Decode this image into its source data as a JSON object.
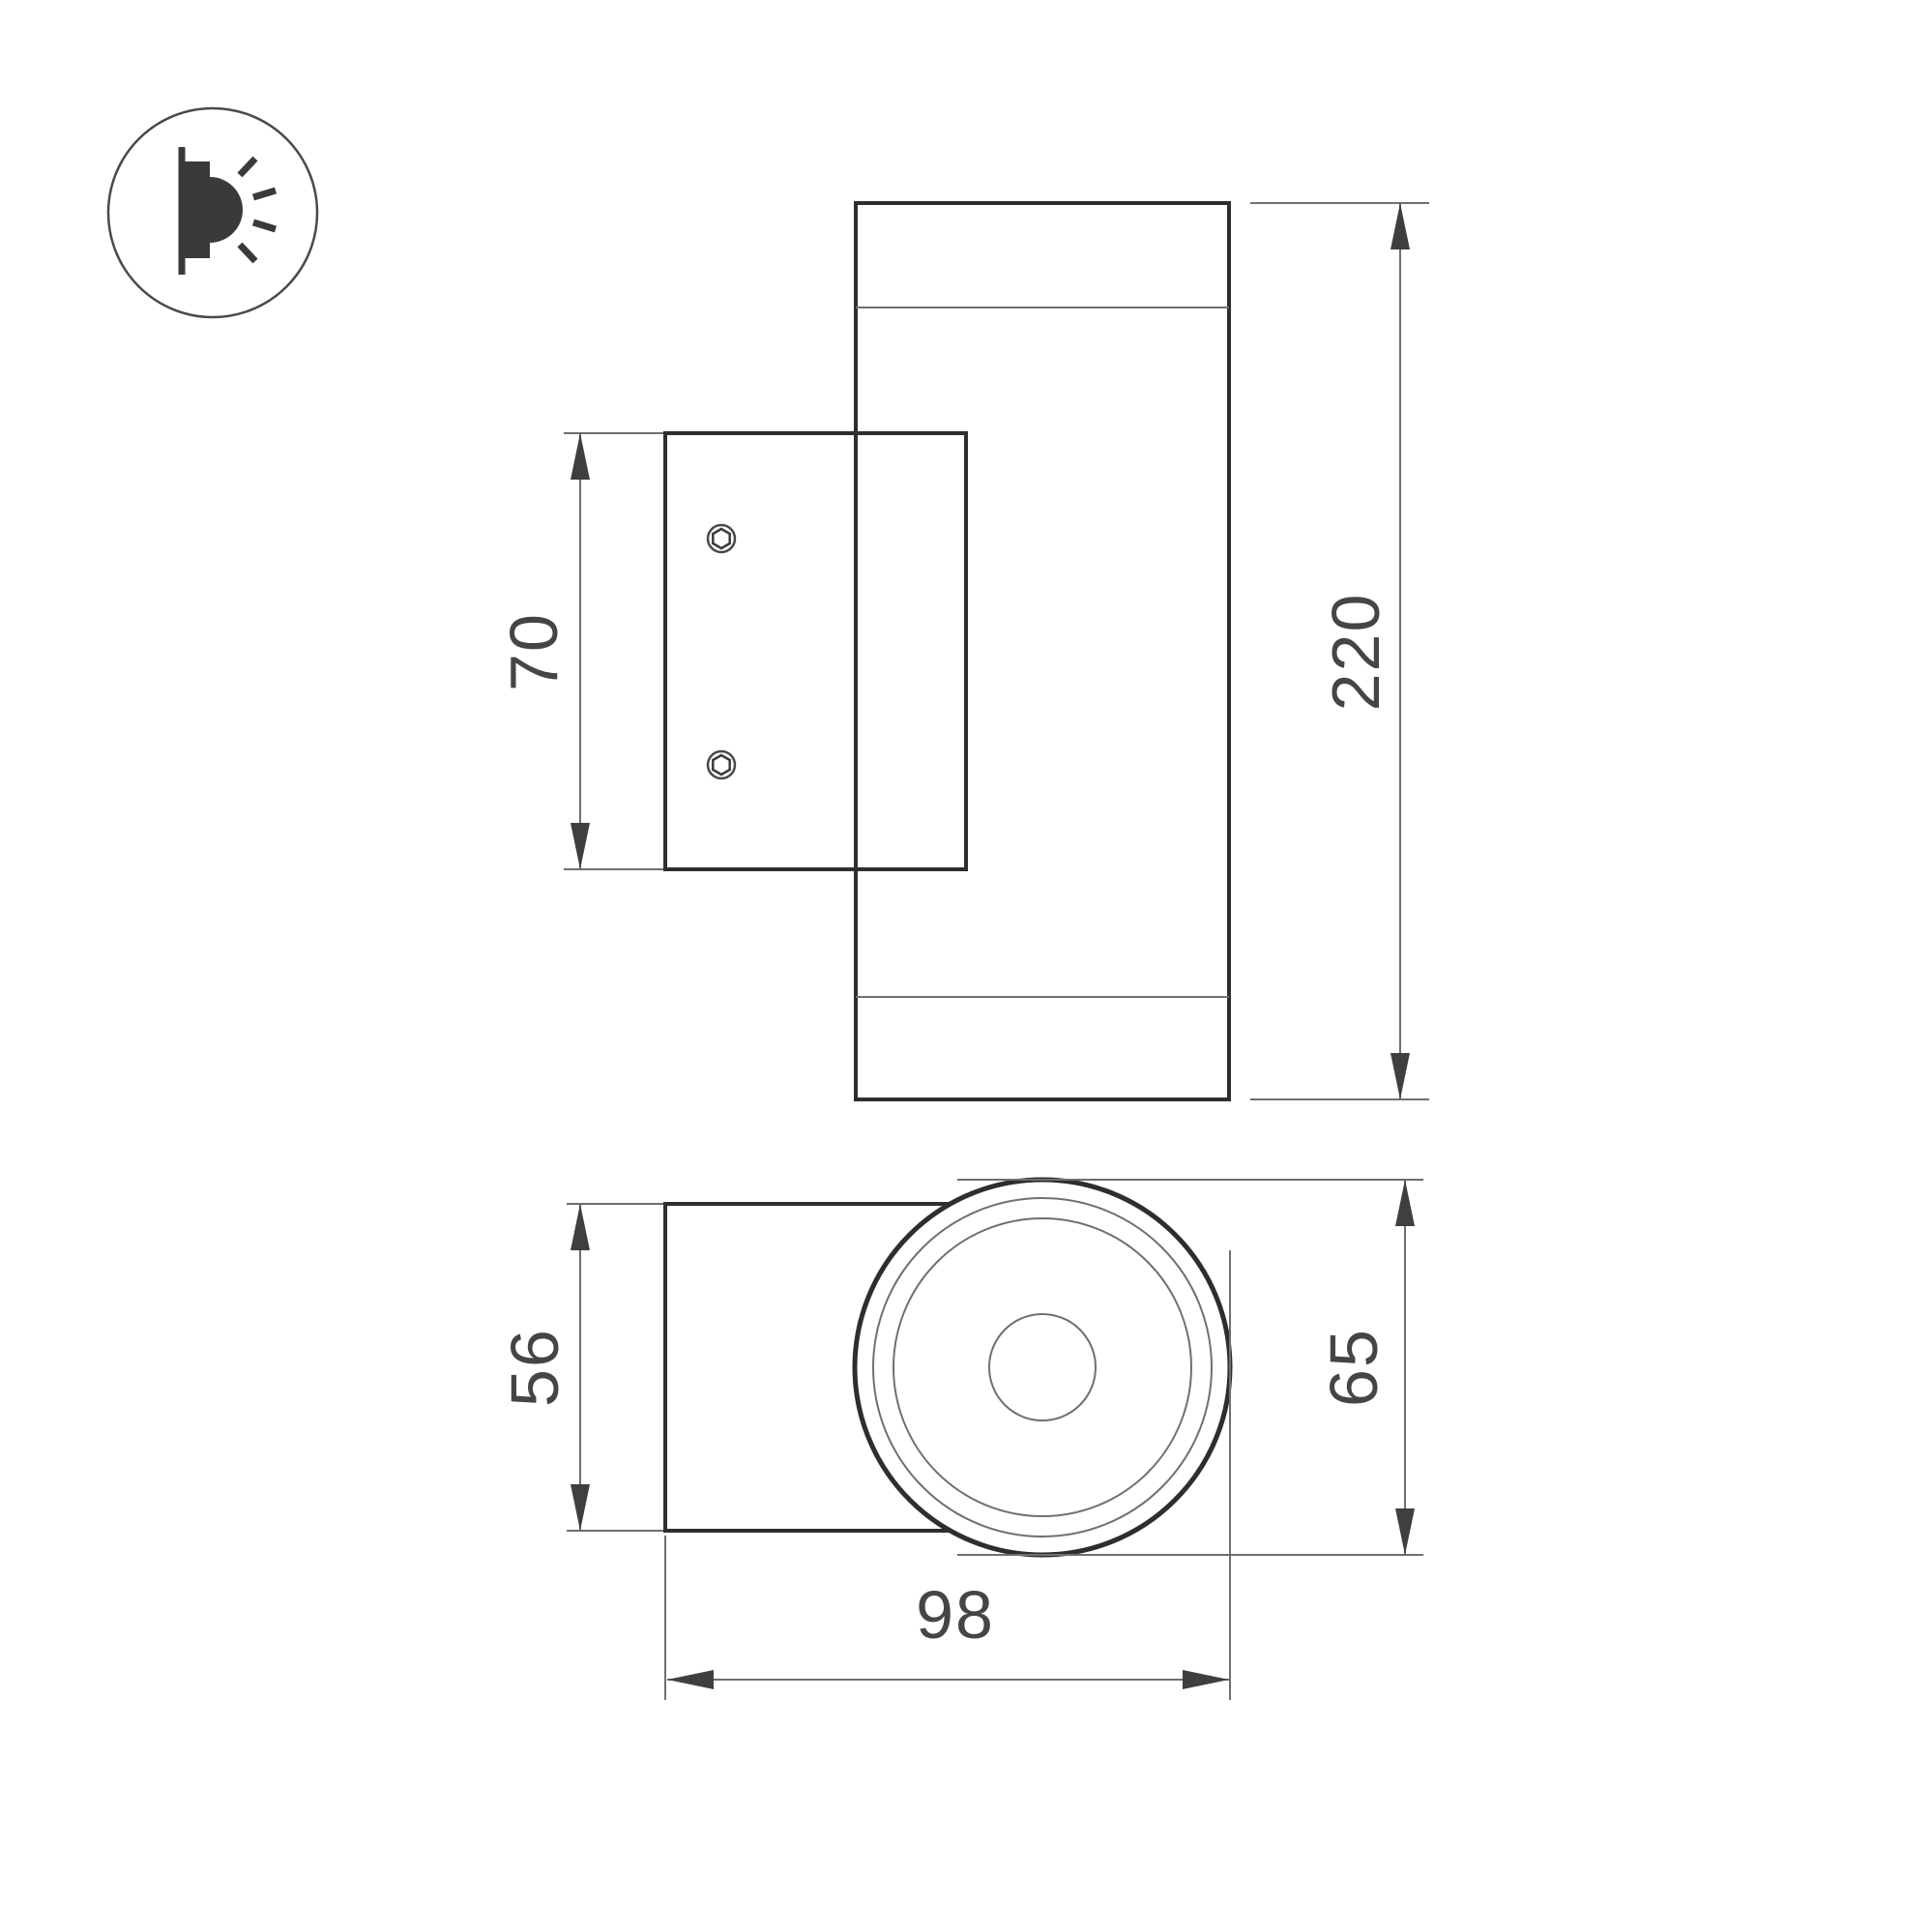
{
  "legend": {
    "icon": "wall-mounted-light-side-emission"
  },
  "side_view": {
    "plate_height_label": "70",
    "overall_height_label": "220"
  },
  "top_view": {
    "body_depth_label": "56",
    "head_diameter_label": "65",
    "overall_depth_label": "98"
  },
  "style": {
    "background": "#ffffff",
    "outline_color": "#2e2e2e",
    "thin_line_color": "#707070",
    "dimension_line_color": "#6f6f6f",
    "arrow_color": "#3f3f3f",
    "text_color": "#454545"
  }
}
